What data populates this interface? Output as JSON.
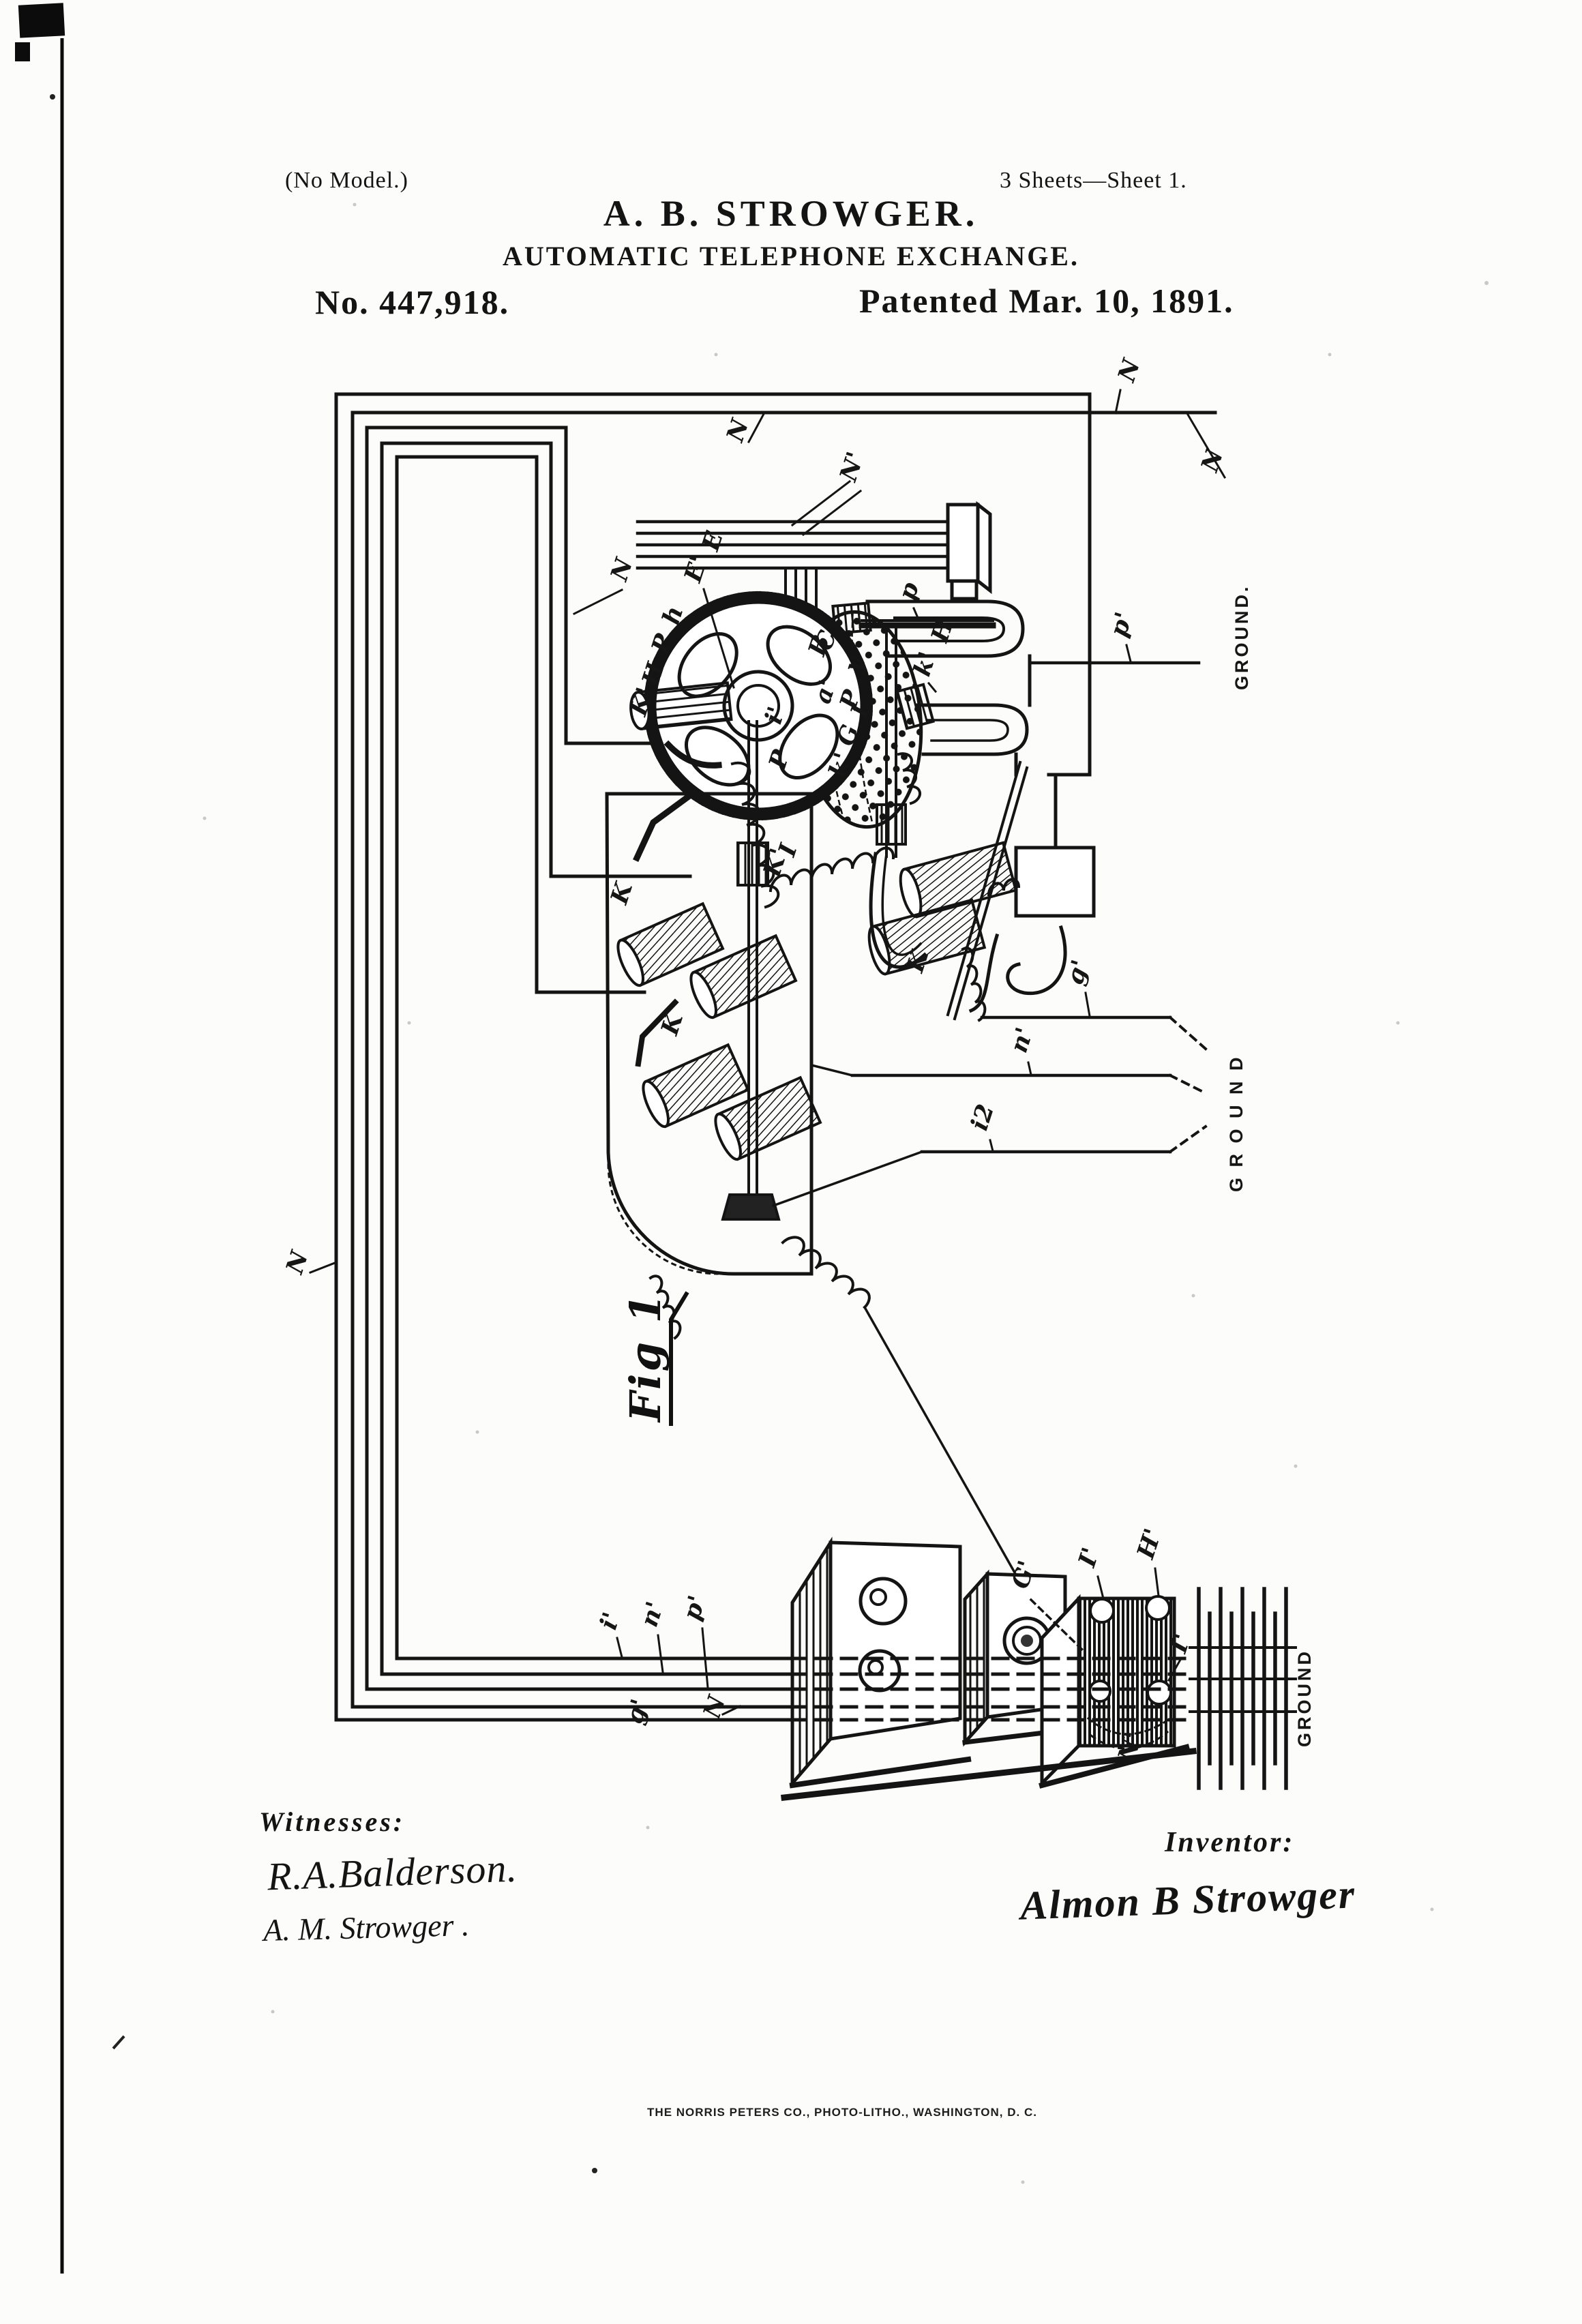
{
  "header": {
    "no_model": "(No Model.)",
    "sheet_info": "3 Sheets—Sheet 1.",
    "inventor_name": "A. B. STROWGER.",
    "invention_title": "AUTOMATIC TELEPHONE EXCHANGE.",
    "patent_number": "No. 447,918.",
    "patent_date": "Patented Mar. 10, 1891."
  },
  "figure": {
    "label": "Fig 1"
  },
  "labels": [
    {
      "text": "N"
    },
    {
      "text": "N'"
    },
    {
      "text": "N"
    },
    {
      "text": "N"
    },
    {
      "text": "N"
    },
    {
      "text": "B"
    },
    {
      "text": "E"
    },
    {
      "text": "E'"
    },
    {
      "text": "h"
    },
    {
      "text": "P"
    },
    {
      "text": "H"
    },
    {
      "text": "K'"
    },
    {
      "text": "C"
    },
    {
      "text": "p"
    },
    {
      "text": "H"
    },
    {
      "text": "k'"
    },
    {
      "text": "y"
    },
    {
      "text": "a'"
    },
    {
      "text": "P"
    },
    {
      "text": "I"
    },
    {
      "text": "G"
    },
    {
      "text": "k'"
    },
    {
      "text": "i'"
    },
    {
      "text": "P"
    },
    {
      "text": "I"
    },
    {
      "text": "K'"
    },
    {
      "text": "K"
    },
    {
      "text": "K"
    },
    {
      "text": "K"
    },
    {
      "text": "p'"
    },
    {
      "text": "g'"
    },
    {
      "text": "n'"
    },
    {
      "text": "i2"
    },
    {
      "text": "i'"
    },
    {
      "text": "n'"
    },
    {
      "text": "p'"
    },
    {
      "text": "g'"
    },
    {
      "text": "N"
    },
    {
      "text": "G'"
    },
    {
      "text": "I'"
    },
    {
      "text": "H'"
    },
    {
      "text": "I'"
    },
    {
      "text": "N'"
    },
    {
      "text": "N"
    }
  ],
  "ground_labels": [
    {
      "text": "GROUND."
    },
    {
      "text": "G R O U N D"
    },
    {
      "text": "GROUND"
    }
  ],
  "footer": {
    "witnesses_heading": "Witnesses:",
    "witness_signature_1": "R.A.Balderson.",
    "witness_signature_2": "A. M. Strowger .",
    "inventor_heading": "Inventor:",
    "inventor_signature": "Almon B Strowger",
    "printer_line": "THE NORRIS PETERS CO., PHOTO-LITHO., WASHINGTON, D. C."
  }
}
